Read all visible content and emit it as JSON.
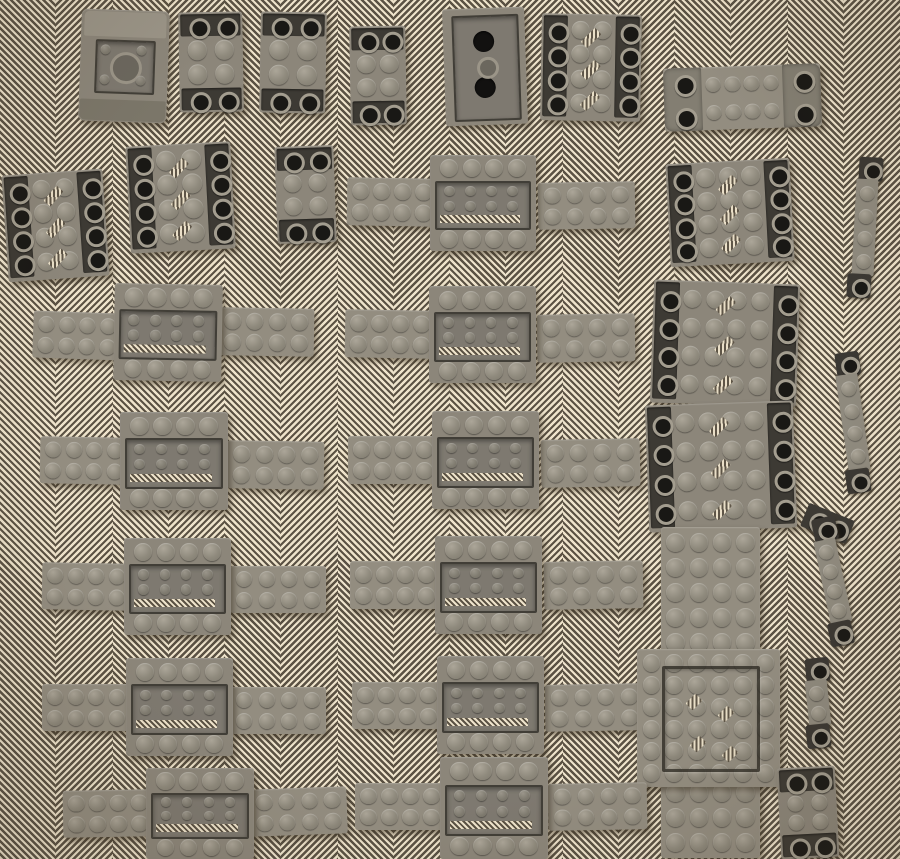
{
  "meta": {
    "description": "Photograph of old dark-gray LEGO parts (inverted slopes, vehicle bases with recessed centers, 2x4 wing plates, mudguard brackets, stud strips and large plates) laid out in seven rows on a cream-and-brown herringbone twill fabric.",
    "width": 900,
    "height": 859
  },
  "palette": {
    "fabric_light": "#eee3cb",
    "fabric_dark": "#5b5244",
    "piece": "#8c867a",
    "piece_light": "#938d80",
    "stud_hi": "#aca699",
    "stud_md": "#8f8a7d",
    "stud_lo": "#7f7a6e",
    "slot_dark": "#3d3a34",
    "ring_gray": "#a39d8f",
    "hole_black": "#191815"
  },
  "fabric": {
    "columns": 16,
    "column_width": 56.25,
    "stripe_period_px": 4.6
  },
  "piece_types": {
    "wedge": "slope-brick-2x2-underside",
    "slope23": "inverted-slope-brick-2x3",
    "brickBottom": "brick-2x4-underside",
    "slopeH": "double-inverted-slope-brick",
    "bracket": "vehicle-mudguard-plate-2x8",
    "plate": "plate",
    "base": "vehicle-base-4x6-recessed-center",
    "ringStrip": "hollow-stud-bar",
    "capStrip": "stud-strip-with-end-bricks",
    "framePlate": "plate-6x6-with-raised-frame"
  },
  "pieces": [
    {
      "t": "wedge",
      "x": 80,
      "y": 10,
      "w": 88,
      "h": 112,
      "r": 2
    },
    {
      "t": "slope23",
      "x": 179,
      "y": 12,
      "w": 64,
      "h": 100,
      "r": -1
    },
    {
      "t": "slope23",
      "x": 260,
      "y": 12,
      "w": 66,
      "h": 101,
      "r": 1
    },
    {
      "t": "slope23",
      "x": 350,
      "y": 26,
      "w": 56,
      "h": 99,
      "r": -1
    },
    {
      "t": "brickBottom",
      "x": 444,
      "y": 8,
      "w": 82,
      "h": 117,
      "r": -2
    },
    {
      "t": "slopeH",
      "cols": 2,
      "x": 541,
      "y": 14,
      "w": 100,
      "h": 107,
      "r": 1
    },
    {
      "t": "bracket",
      "x": 664,
      "y": 66,
      "w": 157,
      "h": 63,
      "r": -2
    },
    {
      "t": "slopeH",
      "cols": 2,
      "x": 5,
      "y": 172,
      "w": 101,
      "h": 107,
      "r": -4
    },
    {
      "t": "slopeH",
      "cols": 2,
      "x": 128,
      "y": 144,
      "w": 105,
      "h": 107,
      "r": -3
    },
    {
      "t": "slope23",
      "x": 276,
      "y": 146,
      "w": 59,
      "h": 97,
      "r": -2
    },
    {
      "t": "plate",
      "cols": 4,
      "rows": 2,
      "x": 347,
      "y": 178,
      "w": 90,
      "h": 48,
      "r": 1
    },
    {
      "t": "plate",
      "cols": 4,
      "rows": 2,
      "x": 538,
      "y": 182,
      "w": 97,
      "h": 47,
      "r": -1
    },
    {
      "t": "base",
      "x": 430,
      "y": 155,
      "w": 106,
      "h": 96,
      "r": 0
    },
    {
      "t": "slopeH",
      "cols": 3,
      "x": 668,
      "y": 161,
      "w": 124,
      "h": 103,
      "r": -3
    },
    {
      "t": "capStrip",
      "studs": 4,
      "x": 843,
      "y": 157,
      "w": 44,
      "h": 141,
      "r": 3
    },
    {
      "t": "plate",
      "cols": 4,
      "rows": 2,
      "x": 33,
      "y": 312,
      "w": 88,
      "h": 47,
      "r": 2
    },
    {
      "t": "plate",
      "cols": 4,
      "rows": 2,
      "x": 218,
      "y": 308,
      "w": 96,
      "h": 48,
      "r": 1
    },
    {
      "t": "base",
      "x": 114,
      "y": 284,
      "w": 108,
      "h": 97,
      "r": 1
    },
    {
      "t": "plate",
      "cols": 4,
      "rows": 2,
      "x": 345,
      "y": 310,
      "w": 90,
      "h": 48,
      "r": 1
    },
    {
      "t": "plate",
      "cols": 4,
      "rows": 2,
      "x": 537,
      "y": 314,
      "w": 98,
      "h": 48,
      "r": -1
    },
    {
      "t": "base",
      "x": 429,
      "y": 286,
      "w": 107,
      "h": 97,
      "r": 0
    },
    {
      "t": "slopeH",
      "cols": 4,
      "x": 652,
      "y": 282,
      "w": 146,
      "h": 123,
      "r": 2
    },
    {
      "t": "capStrip",
      "studs": 4,
      "x": 830,
      "y": 352,
      "w": 46,
      "h": 141,
      "r": -8
    },
    {
      "t": "plate",
      "cols": 4,
      "rows": 2,
      "x": 40,
      "y": 437,
      "w": 88,
      "h": 47,
      "r": 1
    },
    {
      "t": "plate",
      "cols": 4,
      "rows": 2,
      "x": 227,
      "y": 441,
      "w": 97,
      "h": 48,
      "r": 1
    },
    {
      "t": "base",
      "x": 120,
      "y": 412,
      "w": 108,
      "h": 98,
      "r": 0
    },
    {
      "t": "plate",
      "cols": 4,
      "rows": 2,
      "x": 348,
      "y": 436,
      "w": 90,
      "h": 48,
      "r": 0
    },
    {
      "t": "plate",
      "cols": 4,
      "rows": 2,
      "x": 541,
      "y": 439,
      "w": 99,
      "h": 48,
      "r": -1
    },
    {
      "t": "base",
      "x": 432,
      "y": 411,
      "w": 107,
      "h": 98,
      "r": 0
    },
    {
      "t": "slopeH",
      "cols": 4,
      "x": 647,
      "y": 403,
      "w": 148,
      "h": 127,
      "r": -2
    },
    {
      "t": "plate",
      "cols": 4,
      "rows": 2,
      "x": 42,
      "y": 563,
      "w": 88,
      "h": 47,
      "r": 1
    },
    {
      "t": "plate",
      "cols": 4,
      "rows": 2,
      "x": 230,
      "y": 566,
      "w": 96,
      "h": 47,
      "r": 0
    },
    {
      "t": "base",
      "x": 124,
      "y": 538,
      "w": 107,
      "h": 97,
      "r": 0
    },
    {
      "t": "plate",
      "cols": 4,
      "rows": 2,
      "x": 350,
      "y": 561,
      "w": 90,
      "h": 48,
      "r": 0
    },
    {
      "t": "plate",
      "cols": 4,
      "rows": 2,
      "x": 544,
      "y": 561,
      "w": 99,
      "h": 48,
      "r": -1
    },
    {
      "t": "base",
      "x": 435,
      "y": 536,
      "w": 107,
      "h": 98,
      "r": 0
    },
    {
      "t": "plate",
      "cols": 4,
      "rows": 13,
      "x": 661,
      "y": 527,
      "w": 99,
      "h": 331,
      "r": 0
    },
    {
      "t": "ringStrip",
      "n": 2,
      "x": 803,
      "y": 511,
      "w": 49,
      "h": 25,
      "r": 22
    },
    {
      "t": "capStrip",
      "studs": 4,
      "x": 810,
      "y": 517,
      "w": 45,
      "h": 129,
      "r": -12
    },
    {
      "t": "plate",
      "cols": 4,
      "rows": 2,
      "x": 42,
      "y": 684,
      "w": 88,
      "h": 47,
      "r": 0
    },
    {
      "t": "plate",
      "cols": 4,
      "rows": 2,
      "x": 230,
      "y": 687,
      "w": 96,
      "h": 47,
      "r": 0
    },
    {
      "t": "base",
      "x": 126,
      "y": 658,
      "w": 107,
      "h": 98,
      "r": 0
    },
    {
      "t": "plate",
      "cols": 4,
      "rows": 2,
      "x": 352,
      "y": 682,
      "w": 90,
      "h": 47,
      "r": 0
    },
    {
      "t": "plate",
      "cols": 4,
      "rows": 2,
      "x": 545,
      "y": 684,
      "w": 99,
      "h": 47,
      "r": -1
    },
    {
      "t": "base",
      "x": 437,
      "y": 656,
      "w": 107,
      "h": 98,
      "r": 0
    },
    {
      "t": "framePlate",
      "x": 637,
      "y": 649,
      "w": 143,
      "h": 138,
      "r": 0
    },
    {
      "t": "capStrip",
      "studs": 2,
      "x": 797,
      "y": 658,
      "w": 41,
      "h": 90,
      "r": -6
    },
    {
      "t": "plate",
      "cols": 4,
      "rows": 2,
      "x": 63,
      "y": 790,
      "w": 90,
      "h": 47,
      "r": -1
    },
    {
      "t": "plate",
      "cols": 4,
      "rows": 2,
      "x": 250,
      "y": 788,
      "w": 97,
      "h": 47,
      "r": -2
    },
    {
      "t": "base",
      "x": 146,
      "y": 768,
      "w": 108,
      "h": 91,
      "r": 0
    },
    {
      "t": "plate",
      "cols": 4,
      "rows": 2,
      "x": 355,
      "y": 783,
      "w": 90,
      "h": 47,
      "r": 0
    },
    {
      "t": "plate",
      "cols": 4,
      "rows": 2,
      "x": 548,
      "y": 783,
      "w": 99,
      "h": 47,
      "r": -1
    },
    {
      "t": "base",
      "x": 440,
      "y": 757,
      "w": 108,
      "h": 102,
      "r": 0
    },
    {
      "t": "slope23",
      "x": 779,
      "y": 767,
      "w": 58,
      "h": 91,
      "r": -3
    }
  ]
}
